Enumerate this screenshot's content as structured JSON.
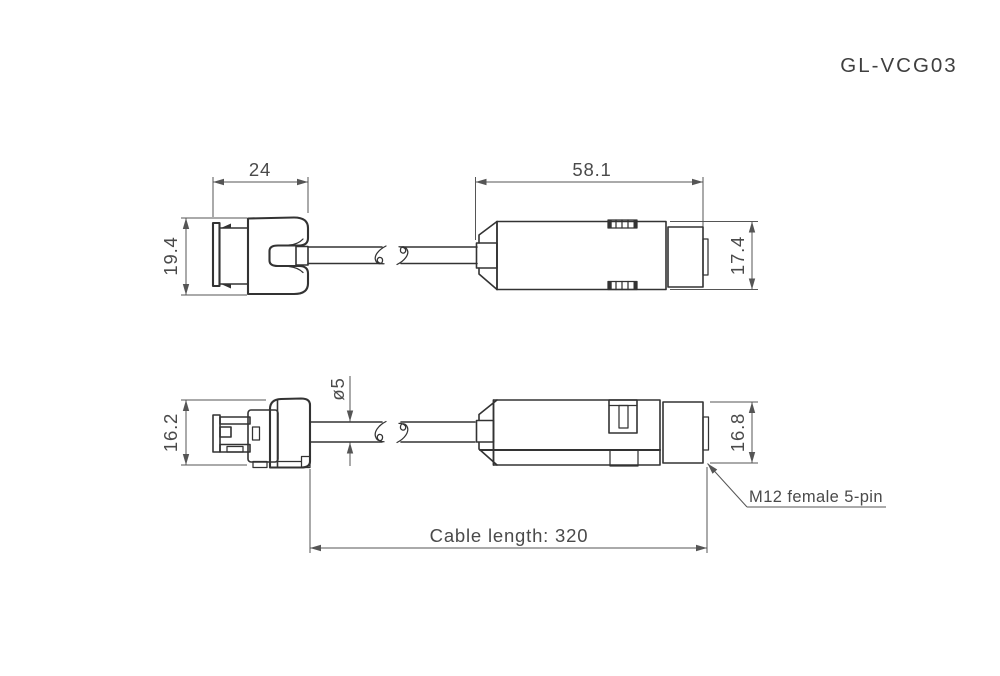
{
  "title": "GL-VCG03",
  "colors": {
    "background": "#ffffff",
    "part_line": "#333333",
    "dimension_line": "#555555",
    "text": "#4a4a4a"
  },
  "top_view": {
    "plug_width": "24",
    "plug_height": "19.4",
    "connector_length": "58.1",
    "connector_height": "17.4"
  },
  "bottom_view": {
    "plug_height": "16.2",
    "cable_diameter": "ø5",
    "connector_height": "16.8",
    "connector_label": "M12 female 5-pin",
    "cable_length_label": "Cable length: 320"
  }
}
